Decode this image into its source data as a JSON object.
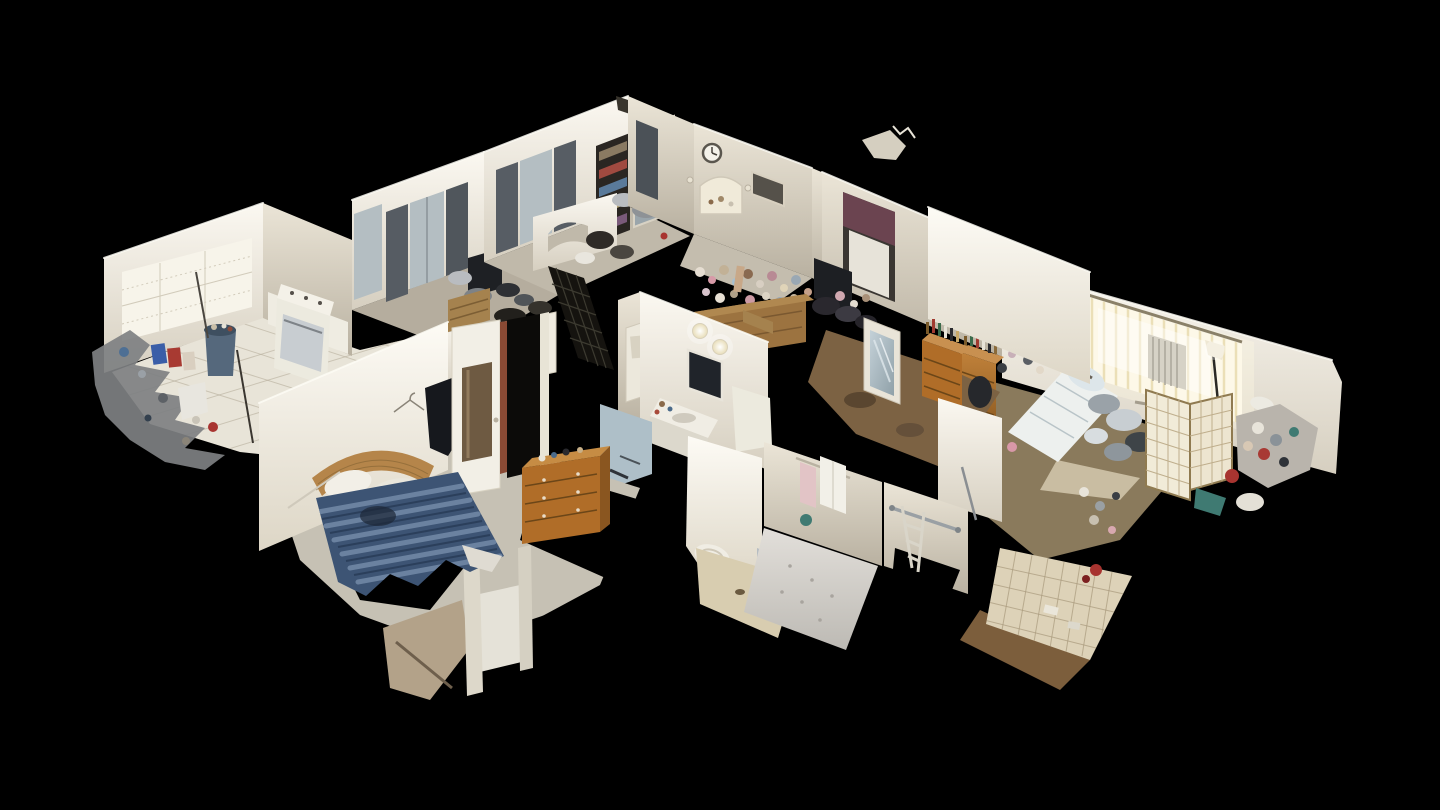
{
  "scene": {
    "type": "dollhouse-3d-scan",
    "description": "Cutaway dollhouse view of a furnished, cluttered single-story home rendered from a 3D scan, seen from above at an angle on a black background",
    "background": "#000000"
  },
  "rooms": [
    {
      "label": "Kitchen"
    },
    {
      "label": "Den office"
    },
    {
      "label": "Living room"
    },
    {
      "label": "Dining room"
    },
    {
      "label": "Cluttered bedroom"
    },
    {
      "label": "Second bedroom"
    },
    {
      "label": "Hallway"
    },
    {
      "label": "Main bathroom"
    },
    {
      "label": "Shower bathroom"
    },
    {
      "label": "Master bedroom"
    }
  ],
  "colors": {
    "background": "#000000",
    "wall_light": "#f2eee3",
    "wall_shadow": "#b7afa0",
    "lace_curtain": "#f7f4ea",
    "gray_curtain": "#565c63",
    "sheer_window": "#b4bec2",
    "plum_valance": "#6b4450",
    "blue_bin": "#55687c",
    "stainless": "#c8cdd1",
    "tile_floor": "#e8e4d8",
    "carpet_gray": "#c6c1b4",
    "carpet_brown": "#7c6243",
    "bed_blue": "#3d5474",
    "bed_stripe": "#7188a6",
    "headboard_wicker": "#b5854a",
    "linens_white": "#edf0ee",
    "wood_dresser": "#b06d28",
    "wood_chest": "#9c7340",
    "window_glow": "#fdf8e8",
    "shoji_screen": "#f1ebd8",
    "mirror_glass": "#aebfc8",
    "security_grid": "#15130f",
    "towel_white": "#f2f0e8",
    "towel_pink": "#e2c4c6",
    "teal_item": "#3f7a72",
    "red_item": "#a83430",
    "silver_clutter": "#9aa2a8",
    "tile_beige": "#ddd2b8",
    "black_hole": "#000000"
  }
}
